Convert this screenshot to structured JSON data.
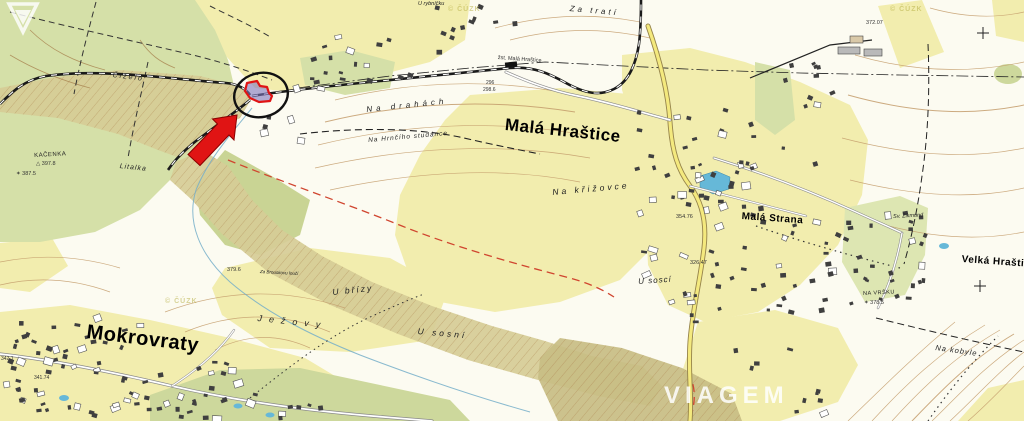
{
  "places": {
    "mokrovraty": "Mokrovraty",
    "mala_hrastice": "Malá Hraštice",
    "velka_hrastice": "Velká Hraštice",
    "mala_strana": "Malá Strana"
  },
  "localities": {
    "cizelo": "Čiželo",
    "kacenka": "KAČENKA",
    "litalka": "Litalka",
    "za_trati": "Za tratí",
    "u_rybnicku": "U rybníčku",
    "zst": "žst. Malá Hraštice",
    "na_drahach": "Na drahách",
    "na_hrnciho_studance": "Na Hrnčího studánce",
    "na_krizovce": "Na křižovce",
    "za_brouskovu_louci": "Za Brouskovu loučí",
    "u_brizy": "U břízy",
    "jezovy": "Ježovy",
    "u_sosni": "U sosní",
    "u_sosci": "U soscí",
    "na_kobyle": "Na kobyle",
    "sv_zikmund": "Sv. Zikmund",
    "na_vrsku": "NA VRŠKU"
  },
  "elevations": {
    "vrch_372": "372.07",
    "station_296": "296",
    "station_2986": "298.6",
    "kacenka": "397.8",
    "kacenka2": "387.5",
    "brizy": "379.6",
    "strana1": "354.76",
    "strana2": "326.47",
    "na_vrsku": "378.5",
    "mokrovraty1": "341.74",
    "mokrovraty2": "342.1"
  },
  "icons": {
    "triangulation": "△",
    "spot_star": "✶"
  },
  "copyright": "© ČÚZK",
  "watermark": {
    "brand": "VIAGEM"
  },
  "colors": {
    "highlight_red": "#e01414",
    "ellipse_black": "#111111",
    "parcel_fill": "#7f76bd",
    "field_yellow": "#f2edae",
    "forest_green": "#d5e0a8",
    "slope_olive": "#d6cc96",
    "contour_brown": "#c49d6c",
    "water_blue": "#66b8d8",
    "watermark_white": "#ffffff"
  }
}
